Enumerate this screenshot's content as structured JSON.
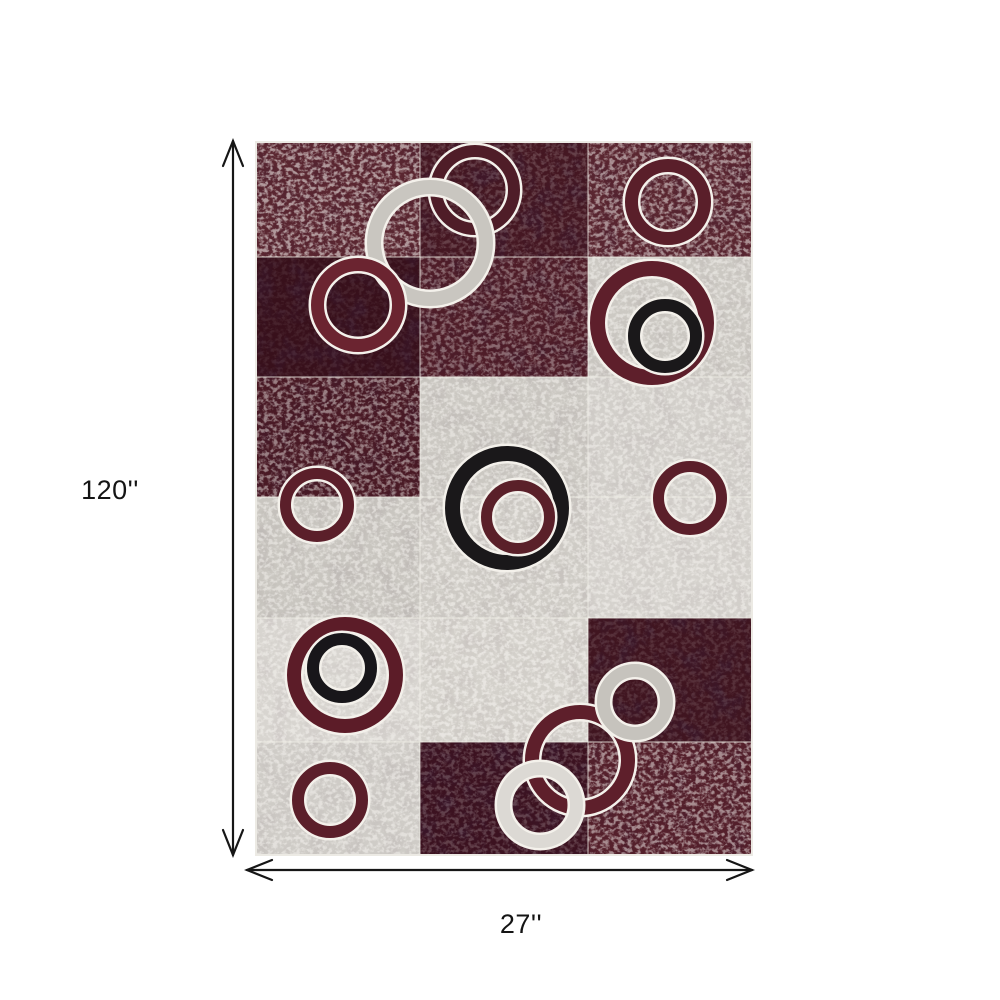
{
  "page": {
    "background": "#ffffff"
  },
  "dimensions": {
    "height_label": "120''",
    "width_label": "27''",
    "arrow_color": "#161616"
  },
  "rug": {
    "x": 255,
    "y": 141,
    "width": 498,
    "height": 715,
    "columns": [
      0,
      165,
      333,
      498
    ],
    "rows": [
      0,
      116,
      236,
      356,
      477,
      601,
      715
    ],
    "edge_color": "#eceae4",
    "grid_line_color": "rgba(240,238,232,0.55)",
    "ring_outline": "#f4f1eb",
    "cells": [
      {
        "row": 0,
        "col": 0,
        "color": "#5a2630",
        "speckle": 0.55,
        "dark": 0.15
      },
      {
        "row": 0,
        "col": 1,
        "color": "#451722",
        "speckle": 0.18,
        "dark": 0.45
      },
      {
        "row": 0,
        "col": 2,
        "color": "#5a2630",
        "speckle": 0.5,
        "dark": 0.2
      },
      {
        "row": 1,
        "col": 0,
        "color": "#38101b",
        "speckle": 0.08,
        "dark": 0.5
      },
      {
        "row": 1,
        "col": 1,
        "color": "#4f1d28",
        "speckle": 0.35,
        "dark": 0.3
      },
      {
        "row": 1,
        "col": 2,
        "color": "#ccc9c3",
        "speckle": 0.5,
        "dark": 0.05
      },
      {
        "row": 2,
        "col": 0,
        "color": "#4a1a25",
        "speckle": 0.45,
        "dark": 0.25
      },
      {
        "row": 2,
        "col": 1,
        "color": "#cbc8c2",
        "speckle": 0.5,
        "dark": 0.05
      },
      {
        "row": 2,
        "col": 2,
        "color": "#d2cfca",
        "speckle": 0.5,
        "dark": 0.04
      },
      {
        "row": 3,
        "col": 0,
        "color": "#c9c6c0",
        "speckle": 0.5,
        "dark": 0.06
      },
      {
        "row": 3,
        "col": 1,
        "color": "#cfccc6",
        "speckle": 0.55,
        "dark": 0.05
      },
      {
        "row": 3,
        "col": 2,
        "color": "#d5d2cd",
        "speckle": 0.5,
        "dark": 0.04
      },
      {
        "row": 4,
        "col": 0,
        "color": "#d8d5d0",
        "speckle": 0.5,
        "dark": 0.04
      },
      {
        "row": 4,
        "col": 1,
        "color": "#d4d1cb",
        "speckle": 0.55,
        "dark": 0.05
      },
      {
        "row": 4,
        "col": 2,
        "color": "#401520",
        "speckle": 0.12,
        "dark": 0.5
      },
      {
        "row": 5,
        "col": 0,
        "color": "#cfccc7",
        "speckle": 0.5,
        "dark": 0.05
      },
      {
        "row": 5,
        "col": 1,
        "color": "#3c1220",
        "speckle": 0.2,
        "dark": 0.5
      },
      {
        "row": 5,
        "col": 2,
        "color": "#55202b",
        "speckle": 0.5,
        "dark": 0.2
      }
    ],
    "rings": [
      {
        "name": "top-red-outline-ring",
        "cx": 220,
        "cy": 49,
        "r": 45,
        "band": 12,
        "color": "#4f1d28"
      },
      {
        "name": "large-gray-ring",
        "cx": 175,
        "cy": 102,
        "r": 63,
        "band": 14,
        "color": "#c9c6c0"
      },
      {
        "name": "top-right-maroon-ring",
        "cx": 413,
        "cy": 61,
        "r": 43,
        "band": 13,
        "color": "#5a1f2a"
      },
      {
        "name": "left-red-ring",
        "cx": 103,
        "cy": 164,
        "r": 47,
        "band": 13,
        "color": "#6b2430"
      },
      {
        "name": "right-red-ring",
        "cx": 397,
        "cy": 182,
        "r": 62,
        "band": 15,
        "color": "#5e1f2b"
      },
      {
        "name": "right-black-ring",
        "cx": 410,
        "cy": 195,
        "r": 37,
        "band": 12,
        "color": "#1a181a"
      },
      {
        "name": "center-black-ring",
        "cx": 252,
        "cy": 367,
        "r": 62,
        "band": 15,
        "color": "#1a181a"
      },
      {
        "name": "center-red-ring",
        "cx": 263,
        "cy": 376,
        "r": 37,
        "band": 11,
        "color": "#5a2029"
      },
      {
        "name": "mid-left-maroon-ring",
        "cx": 62,
        "cy": 364,
        "r": 37,
        "band": 11,
        "color": "#5b1f2a"
      },
      {
        "name": "mid-right-maroon-ring",
        "cx": 435,
        "cy": 357,
        "r": 37,
        "band": 11,
        "color": "#5b1f2a"
      },
      {
        "name": "lower-left-red-ring",
        "cx": 90,
        "cy": 534,
        "r": 58,
        "band": 14,
        "color": "#5c1c28"
      },
      {
        "name": "lower-left-black-ring",
        "cx": 87,
        "cy": 527,
        "r": 35,
        "band": 12,
        "color": "#18161a"
      },
      {
        "name": "bottom-left-maroon-ring",
        "cx": 75,
        "cy": 659,
        "r": 38,
        "band": 12,
        "color": "#5b1f2a"
      },
      {
        "name": "cluster-red-ring",
        "cx": 325,
        "cy": 619,
        "r": 55,
        "band": 14,
        "color": "#5e1f2b"
      },
      {
        "name": "cluster-gray-ring",
        "cx": 380,
        "cy": 561,
        "r": 38,
        "band": 13,
        "color": "#c6c3bd"
      },
      {
        "name": "cluster-white-ring",
        "cx": 285,
        "cy": 664,
        "r": 43,
        "band": 13,
        "color": "#dcd9d4"
      }
    ]
  }
}
